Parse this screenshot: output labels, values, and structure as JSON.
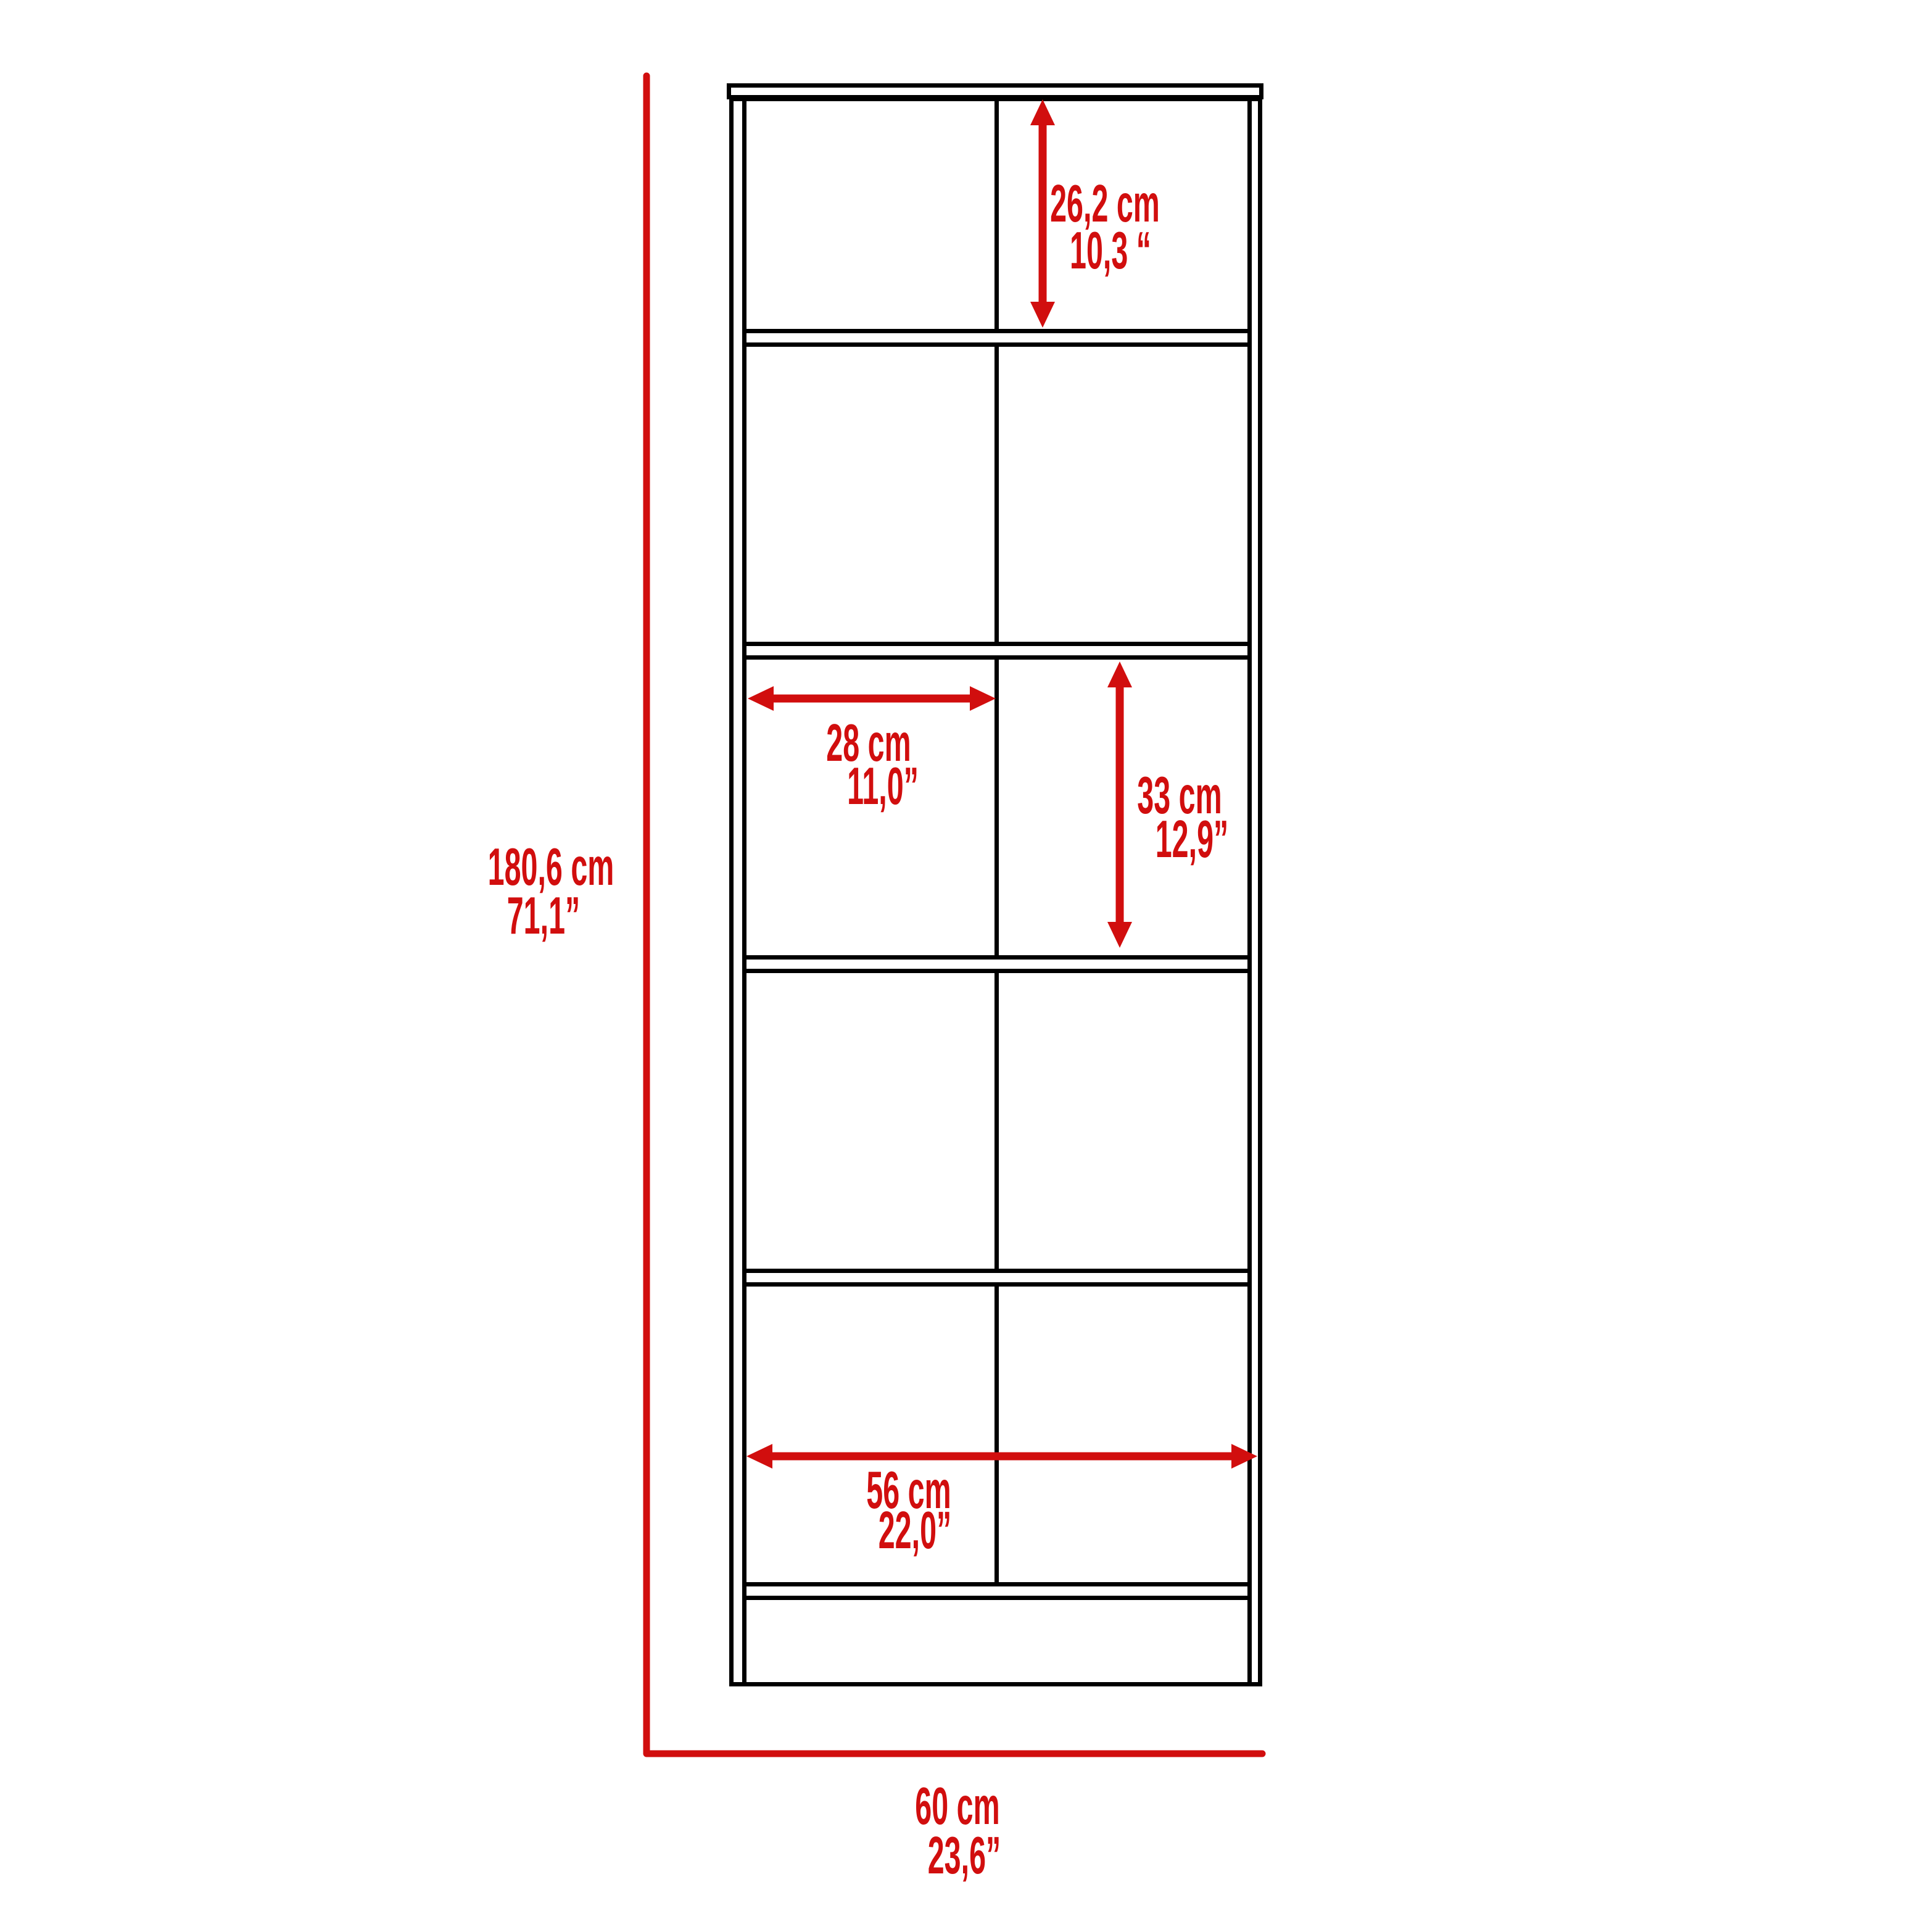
{
  "diagram": {
    "type": "furniture-dimension-drawing",
    "background": "#ffffff",
    "outline_color": "#000000",
    "dimension_color": "#d10e0e",
    "structure": {
      "columns": 2,
      "shelf_rows": 5,
      "has_top_board": true,
      "has_base_panel": true
    },
    "labels": {
      "top_shelf_height": {
        "cm": "26,2 cm",
        "inch": "10,3 “"
      },
      "shelf_width": {
        "cm": "28 cm",
        "inch": "11,0”"
      },
      "shelf_height": {
        "cm": "33 cm",
        "inch": "12,9”"
      },
      "inner_width": {
        "cm": "56 cm",
        "inch": "22,0”"
      },
      "overall_height": {
        "cm": "180,6 cm",
        "inch": "71,1”"
      },
      "overall_width": {
        "cm": "60 cm",
        "inch": "23,6”"
      }
    }
  }
}
